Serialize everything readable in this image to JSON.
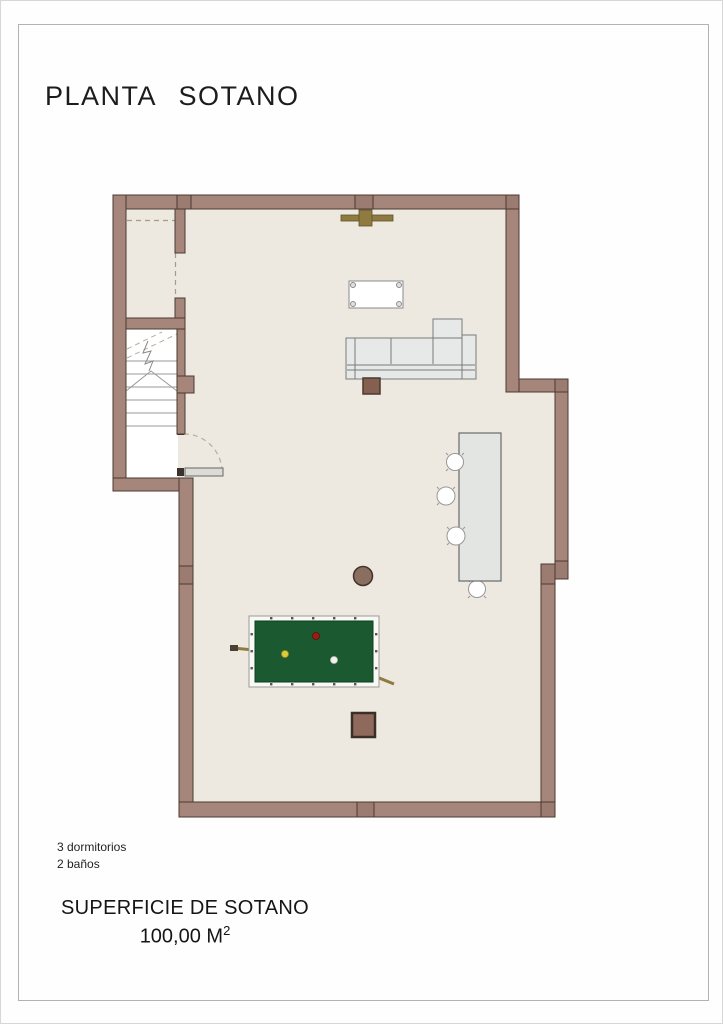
{
  "document": {
    "title": "PLANTA SOTANO",
    "notes": {
      "line1": "3 dormitorios",
      "line2": "2 baños"
    },
    "surface": {
      "label": "SUPERFICIE DE SOTANO",
      "value": "100,00 M",
      "superscript": "2"
    }
  },
  "plan": {
    "type": "architectural-floor-plan-basement",
    "symbols": [
      "staircase",
      "swing-door",
      "coffee-table",
      "sectional-sofa",
      "bar-table",
      "stools",
      "billiard-table",
      "billiard-cues",
      "columns",
      "ceiling-light"
    ],
    "colors": {
      "wall": "#A6857B",
      "wall_joint": "#9C7B71",
      "wall_outline": "#4A3B32",
      "floor": "#EDE9E0",
      "stairwell": "#FFFFFF",
      "billiard_felt": "#1B5A30",
      "wood_accent": "#8F7B40",
      "furniture_gray": "#E7E9E9"
    }
  }
}
